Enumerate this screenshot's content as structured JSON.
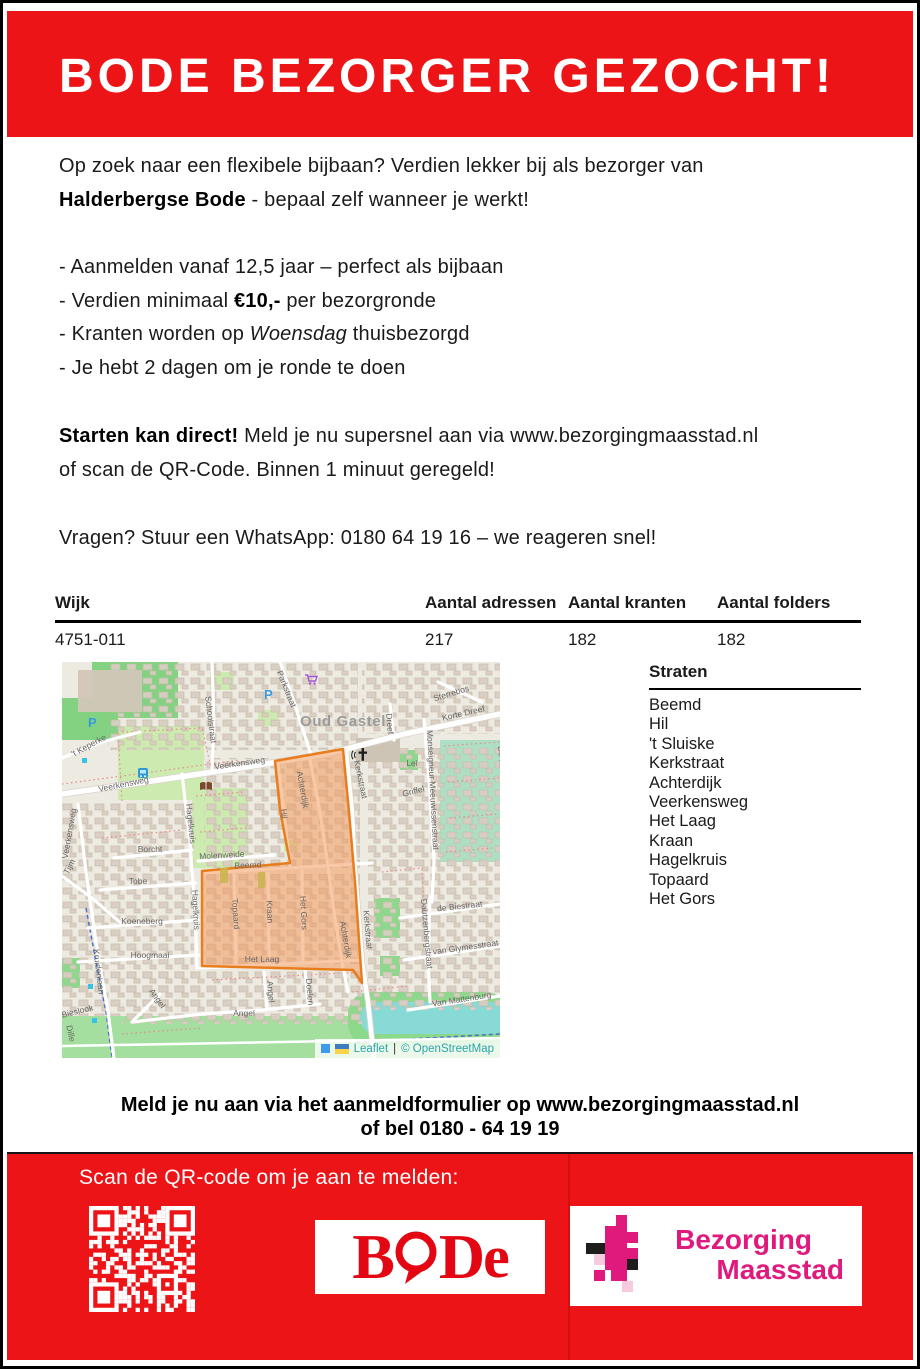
{
  "header": {
    "title": "BODE BEZORGER GEZOCHT!"
  },
  "intro": {
    "line1": "Op zoek naar een flexibele bijbaan? Verdien lekker bij als bezorger van",
    "brand": "Halderbergse Bode",
    "line2_rest": " - bepaal zelf wanneer je werkt!"
  },
  "bullets": {
    "b1": "- Aanmelden vanaf 12,5 jaar – perfect als bijbaan",
    "b2_pre": "- Verdien minimaal ",
    "b2_bold": "€10,-",
    "b2_post": " per bezorgronde",
    "b3_pre": "- Kranten worden op ",
    "b3_italic": "Woensdag",
    "b3_post": " thuisbezorgd",
    "b4": "- Je hebt 2 dagen om je ronde te doen"
  },
  "cta": {
    "bold": "Starten kan direct!",
    "rest": " Meld je nu supersnel aan via www.bezorgingmaasstad.nl",
    "line2": "of scan de QR-Code. Binnen 1 minuut geregeld!"
  },
  "questions": "Vragen? Stuur een WhatsApp: 0180 64 19 16 – we reageren snel!",
  "table": {
    "headers": [
      "Wijk",
      "Aantal adressen",
      "Aantal kranten",
      "Aantal folders"
    ],
    "rows": [
      [
        "4751-011",
        "217",
        "182",
        "182"
      ]
    ]
  },
  "straten": {
    "title": "Straten",
    "items": [
      "Beemd",
      "Hil",
      "'t Sluiske",
      "Kerkstraat",
      "Achterdijk",
      "Veerkensweg",
      "Het Laag",
      "Kraan",
      "Hagelkruis",
      "Topaard",
      "Het Gors"
    ]
  },
  "map": {
    "place_label": "Oud Gastel",
    "street_labels": [
      {
        "t": "Schoolstraat",
        "x": 146,
        "y": 58,
        "r": 83
      },
      {
        "t": "Parkstraat",
        "x": 222,
        "y": 28,
        "r": 68
      },
      {
        "t": "Veerkensweg",
        "x": 62,
        "y": 125,
        "r": -11
      },
      {
        "t": "Veerkensweg",
        "x": 178,
        "y": 104,
        "r": -8
      },
      {
        "t": "Veerkensweg",
        "x": 10,
        "y": 172,
        "r": -80
      },
      {
        "t": "'t Keperke",
        "x": 28,
        "y": 86,
        "r": -28
      },
      {
        "t": "Tijm",
        "x": 10,
        "y": 206,
        "r": -62
      },
      {
        "t": "Dreef",
        "x": 325,
        "y": 62,
        "r": 85
      },
      {
        "t": "Korte Dreef",
        "x": 402,
        "y": 54,
        "r": -13
      },
      {
        "t": "Sterrebos",
        "x": 390,
        "y": 34,
        "r": -17
      },
      {
        "t": "Monseigneur Meeuwissenstraat",
        "x": 368,
        "y": 128,
        "r": 87
      },
      {
        "t": "De Ka",
        "x": 437,
        "y": 96,
        "r": 85
      },
      {
        "t": "Griffel",
        "x": 352,
        "y": 132,
        "r": -14
      },
      {
        "t": "Lei",
        "x": 350,
        "y": 104,
        "r": 0
      },
      {
        "t": "Hagelkruis",
        "x": 126,
        "y": 162,
        "r": 84
      },
      {
        "t": "Hagelkruis",
        "x": 131,
        "y": 248,
        "r": 87
      },
      {
        "t": "Borcht",
        "x": 88,
        "y": 190,
        "r": 0
      },
      {
        "t": "Tobe",
        "x": 76,
        "y": 222,
        "r": 0
      },
      {
        "t": "Molenweide",
        "x": 160,
        "y": 196,
        "r": -3
      },
      {
        "t": "Koeneberg",
        "x": 80,
        "y": 262,
        "r": 0
      },
      {
        "t": "Hoogmaai",
        "x": 88,
        "y": 296,
        "r": 0
      },
      {
        "t": "Beemd",
        "x": 186,
        "y": 206,
        "r": -2
      },
      {
        "t": "Topaard",
        "x": 171,
        "y": 252,
        "r": 86
      },
      {
        "t": "Kraan",
        "x": 205,
        "y": 250,
        "r": 87
      },
      {
        "t": "Het Gors",
        "x": 239,
        "y": 251,
        "r": 87
      },
      {
        "t": "Hil",
        "x": 219,
        "y": 152,
        "r": 85
      },
      {
        "t": "Achterdijk",
        "x": 238,
        "y": 128,
        "r": 80
      },
      {
        "t": "Achterdijk",
        "x": 281,
        "y": 278,
        "r": 80
      },
      {
        "t": "Kerkstraat",
        "x": 296,
        "y": 118,
        "r": 78
      },
      {
        "t": "Kerkstraat",
        "x": 303,
        "y": 268,
        "r": 85
      },
      {
        "t": "Het Laag",
        "x": 200,
        "y": 300,
        "r": 0
      },
      {
        "t": "Angel",
        "x": 206,
        "y": 330,
        "r": 85
      },
      {
        "t": "Angel",
        "x": 182,
        "y": 354,
        "r": 0
      },
      {
        "t": "Angel",
        "x": 93,
        "y": 338,
        "r": 55
      },
      {
        "t": "Doelen",
        "x": 245,
        "y": 330,
        "r": 85
      },
      {
        "t": "de Biestraat",
        "x": 398,
        "y": 247,
        "r": -6
      },
      {
        "t": "van Glymesstraat",
        "x": 404,
        "y": 288,
        "r": -8
      },
      {
        "t": "Van Mattenburg",
        "x": 400,
        "y": 340,
        "r": -9
      },
      {
        "t": "Dautzenbergstraat",
        "x": 362,
        "y": 272,
        "r": 85
      },
      {
        "t": "Bieslook",
        "x": 16,
        "y": 352,
        "r": -14
      },
      {
        "t": "Dille",
        "x": 6,
        "y": 372,
        "r": 78
      },
      {
        "t": "Kruidenlaan",
        "x": 34,
        "y": 310,
        "r": 83
      }
    ],
    "icons": [
      {
        "n": "parking",
        "x": 26,
        "y": 54
      },
      {
        "n": "parking",
        "x": 202,
        "y": 26
      },
      {
        "n": "cart",
        "x": 243,
        "y": 12
      },
      {
        "n": "bus",
        "x": 76,
        "y": 106
      },
      {
        "n": "book",
        "x": 138,
        "y": 120
      },
      {
        "n": "church",
        "x": 296,
        "y": 86
      },
      {
        "n": "dot-blue",
        "x": 20,
        "y": 96
      },
      {
        "n": "dot-blue",
        "x": 26,
        "y": 322
      },
      {
        "n": "dot-blue",
        "x": 30,
        "y": 356
      }
    ],
    "attribution": {
      "leaflet": "Leaflet",
      "sep": "|",
      "osm": "© OpenStreetMap"
    }
  },
  "bottom": {
    "line1": "Meld je nu aan via het aanmeldformulier op www.bezorgingmaasstad.nl",
    "line2": "of bel 0180 - 64 19 19"
  },
  "footer": {
    "scan_label": "Scan de QR-code om je aan te melden:",
    "bode": {
      "b": "B",
      "d": "D",
      "e": "e"
    },
    "maasstad_line1": "Bezorging",
    "maasstad_line2": "Maasstad"
  },
  "colors": {
    "flyer_red": "#ED1418",
    "bode_red": "#E30613",
    "maasstad_magenta": "#E0197D",
    "maasstad_pink": "#F7CBDD",
    "osm_link_teal": "#2AA4A8",
    "polygon_orange_stroke": "#E87D1E",
    "polygon_orange_fill": "#F29A5E"
  }
}
